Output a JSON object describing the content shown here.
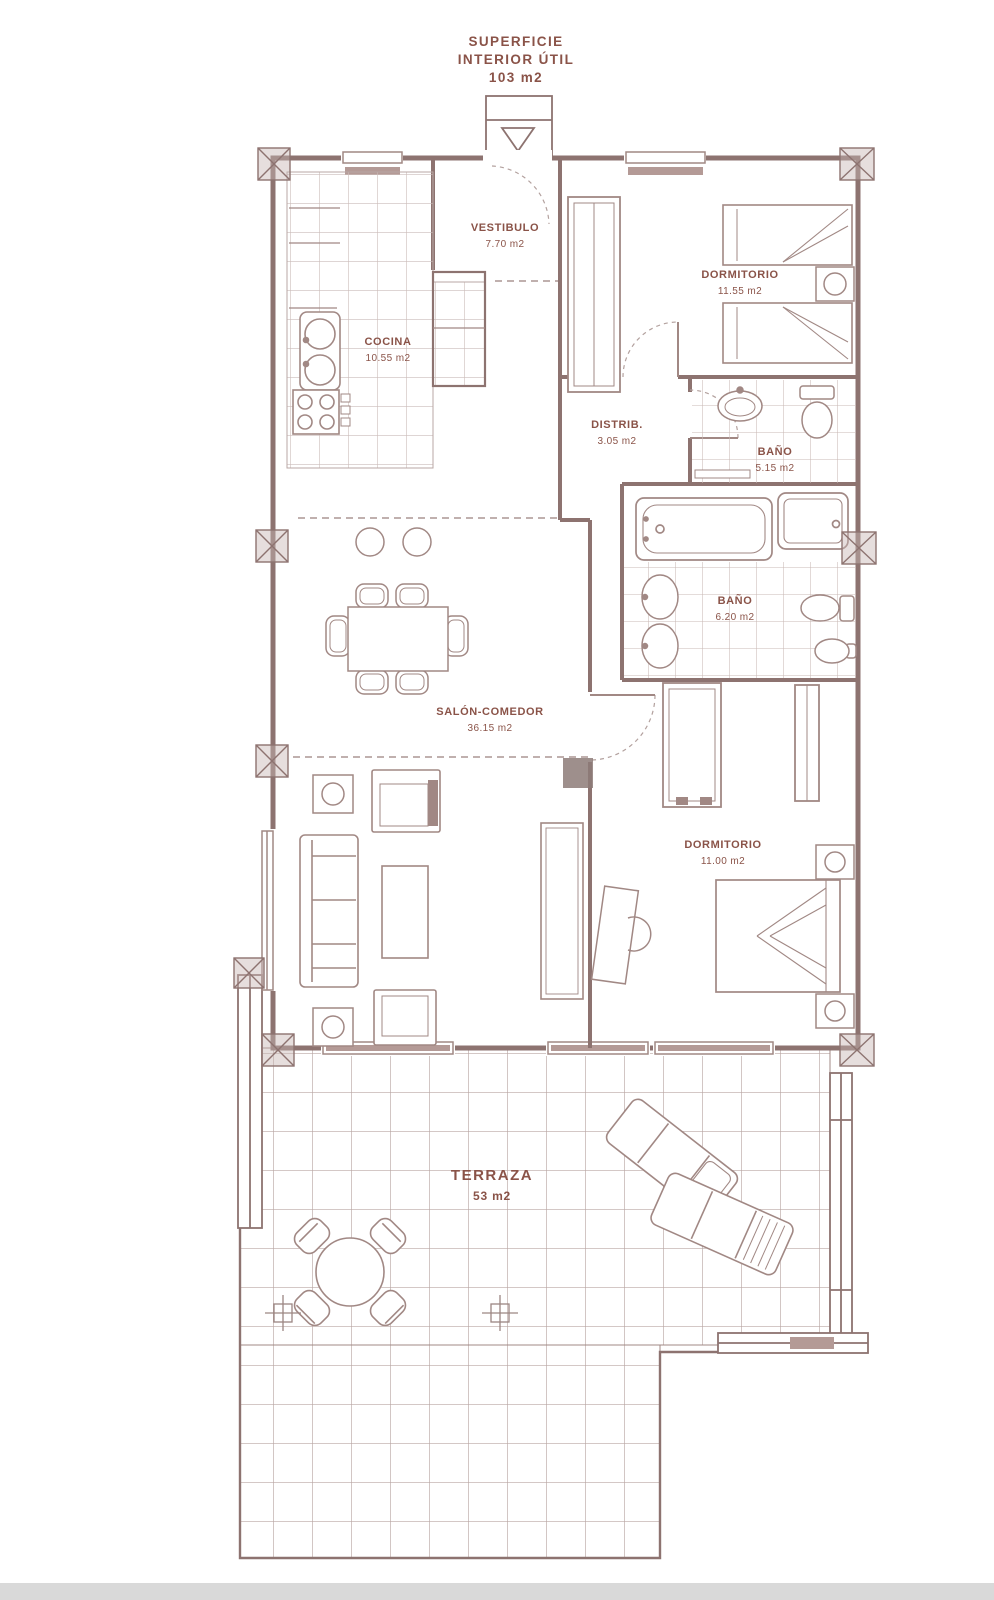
{
  "title": {
    "line1": "SUPERFICIE",
    "line2": "INTERIOR ÚTIL",
    "area": "103 m2"
  },
  "rooms": {
    "vestibulo": {
      "name": "VESTIBULO",
      "area": "7.70 m2"
    },
    "cocina": {
      "name": "COCINA",
      "area": "10.55 m2"
    },
    "dormitorio1": {
      "name": "DORMITORIO",
      "area": "11.55 m2"
    },
    "distribuidor": {
      "name": "DISTRIB.",
      "area": "3.05 m2"
    },
    "bano1": {
      "name": "BAÑO",
      "area": "5.15 m2"
    },
    "bano2": {
      "name": "BAÑO",
      "area": "6.20 m2"
    },
    "salon": {
      "name": "SALÓN-COMEDOR",
      "area": "36.15 m2"
    },
    "dormitorio2": {
      "name": "DORMITORIO",
      "area": "11.00 m2"
    },
    "terraza": {
      "name": "TERRAZA",
      "area": "53 m2"
    }
  },
  "colors": {
    "wall": "#8d7370",
    "furniture": "#a18884",
    "grid": "#cbbcb9",
    "label": "#8a5348",
    "window_fill": "#b49a96",
    "footer_bar": "#d9d9d9"
  }
}
